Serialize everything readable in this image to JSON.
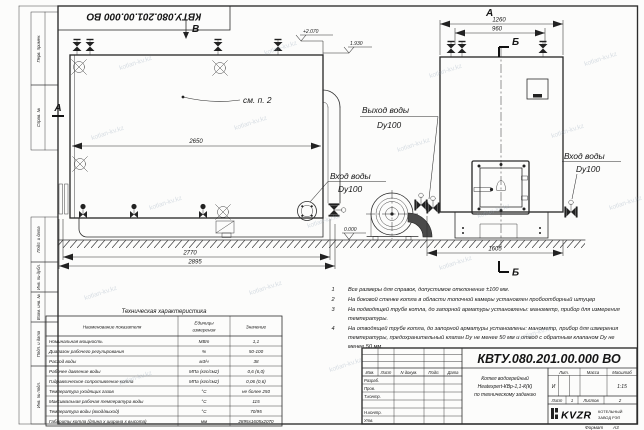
{
  "sheet": {
    "stamp_top": "КВТУ.080.201.00.000  ВО",
    "format_label": "Формат",
    "format_value": "А3"
  },
  "watermark": {
    "text": "kotlan-kv.kz"
  },
  "margins": {
    "labels": [
      "Перв. примен.",
      "Справ. №",
      "Подп. и дата",
      "Инв. № дубл.",
      "Взам. инв. №",
      "Подп. и дата",
      "Инв. № подл."
    ]
  },
  "drawing": {
    "view_labels": {
      "front_arrow": "В",
      "side_title": "А",
      "section_left": "А",
      "section_b_top": "Б",
      "section_b_bottom": "Б"
    },
    "callout_note": "см. п. 2",
    "elevations": {
      "top": "+2.070",
      "shell_top": "1.930",
      "ground": "0.000"
    },
    "dims": {
      "front_shell_length": "2650",
      "front_length": "2770",
      "front_overall": "2895",
      "side_width_overall": "1260",
      "side_width_inner": "960",
      "side_depth": "1605"
    },
    "labels": {
      "water_outlet_line1": "Выход воды",
      "water_outlet_line2": "Dy100",
      "water_inlet_front_line1": "Вход воды",
      "water_inlet_front_line2": "Dy100",
      "water_inlet_side_line1": "Вход воды",
      "water_inlet_side_line2": "Dy100"
    }
  },
  "notes": {
    "items": [
      {
        "num": "1",
        "lines": [
          "Все размеры для справок, допустимое отклонение ±100 мм."
        ]
      },
      {
        "num": "2",
        "lines": [
          "На боковой стенке котла в области топочной камеры установлен пробоотборный штуцер"
        ]
      },
      {
        "num": "3",
        "lines": [
          "На  подводящей трубе котла, до запорной арматуры установлены: манометр, прибор для измерения",
          "температуры."
        ]
      },
      {
        "num": "4",
        "lines": [
          "На отводящей трубе котла, до запорной арматуры установлены: манометр, прибор для измерения",
          "температуры, предохранительный клапан Dу не менее 50 мм и отвод с обратным клапаном Dу не",
          "менее 50 мм."
        ]
      }
    ]
  },
  "tech_table": {
    "title": "Техническая характеристика",
    "headers": {
      "name": "Наименование показателя",
      "unit_line1": "Единицы",
      "unit_line2": "измерения",
      "value": "Значение"
    },
    "rows": [
      {
        "name": "Номинальная мощность",
        "unit": "МВт",
        "value": "1,1"
      },
      {
        "name": "Диапазон рабочего регулирования",
        "unit": "%",
        "value": "50-100"
      },
      {
        "name": "Расход воды",
        "unit": "м3/ч",
        "value": "38"
      },
      {
        "name": "Рабочее давление воды",
        "unit": "МПа (кгс/см2)",
        "value": "0,6 (6,0)"
      },
      {
        "name": "Гидравлическое сопротивление котла",
        "unit": "МПа (кгс/см2)",
        "value": "0,06 (0,6)"
      },
      {
        "name": "Температура уходящих газов",
        "unit": "°С",
        "value": "не более 250"
      },
      {
        "name": "Максимальная рабочая температура воды",
        "unit": "°С",
        "value": "115"
      },
      {
        "name": "Температура воды (вход/выход)",
        "unit": "°С",
        "value": "70/95"
      },
      {
        "name": "Габариты котла (длина х ширина х высота)",
        "unit": "мм",
        "value": "2895х1605х2070"
      }
    ]
  },
  "title_block": {
    "doc_number": "КВТУ.080.201.00.000  ВО",
    "product_lines": [
      "Котел водогрейный",
      "Heatexpert-КВр-1,1-К(К)",
      "по техническому заданию"
    ],
    "columns": [
      "Изм.",
      "Лист",
      "N докум.",
      "Подп.",
      "Дата"
    ],
    "sig_rows": [
      "Разраб.",
      "Пров.",
      "Т.контр.",
      "Н.контр.",
      "Утв."
    ],
    "litera_header": "Лит.",
    "mass_header": "Масса",
    "scale_header": "Масштаб",
    "litera": "И",
    "scale": "1:15",
    "sheet_label": "Лист",
    "sheet_number": "1",
    "sheets_label": "Листов",
    "sheets_total": "2",
    "company_logo": "KVZR",
    "company_line1": "КОТЕЛЬНЫЙ",
    "company_line2": "ЗАВОД РЭП"
  }
}
